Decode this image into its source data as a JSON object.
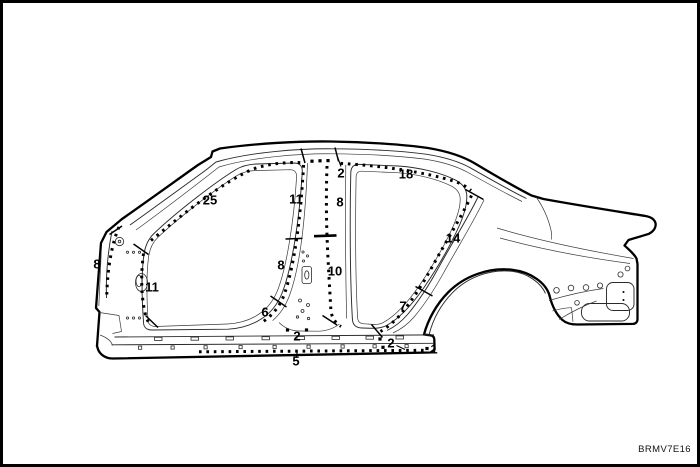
{
  "figure": {
    "code": "BRMV7E16",
    "colors": {
      "line": "#141414",
      "background": "#ffffff",
      "frame": "#000000"
    },
    "callouts": [
      {
        "id": "25-front-roof-rail",
        "text": "25",
        "x": 210,
        "y": 200
      },
      {
        "id": "11-b-pillar-front",
        "text": "11",
        "x": 296,
        "y": 199
      },
      {
        "id": "2-roof-rail",
        "text": "2",
        "x": 341,
        "y": 173
      },
      {
        "id": "18-rear-roof-rail",
        "text": "18",
        "x": 406,
        "y": 174
      },
      {
        "id": "8-b-pillar-rear",
        "text": "8",
        "x": 340,
        "y": 202
      },
      {
        "id": "14-c-pillar",
        "text": "14",
        "x": 453,
        "y": 238
      },
      {
        "id": "8-a-pillar",
        "text": "8",
        "x": 97,
        "y": 264
      },
      {
        "id": "11-a-pillar-inner",
        "text": "11",
        "x": 152,
        "y": 287
      },
      {
        "id": "8-b-pillar-lower",
        "text": "8",
        "x": 281,
        "y": 265
      },
      {
        "id": "10-b-pillar-lower",
        "text": "10",
        "x": 335,
        "y": 271
      },
      {
        "id": "6-door-corner",
        "text": "6",
        "x": 265,
        "y": 312
      },
      {
        "id": "2-b-pillar-base",
        "text": "2",
        "x": 297,
        "y": 336
      },
      {
        "id": "7-quarter-lower",
        "text": "7",
        "x": 403,
        "y": 306
      },
      {
        "id": "2-quarter-sill",
        "text": "2",
        "x": 391,
        "y": 343
      },
      {
        "id": "1-sill-end",
        "text": "1",
        "x": 434,
        "y": 349
      },
      {
        "id": "5-rocker-panel",
        "text": "5",
        "x": 296,
        "y": 361
      }
    ]
  }
}
